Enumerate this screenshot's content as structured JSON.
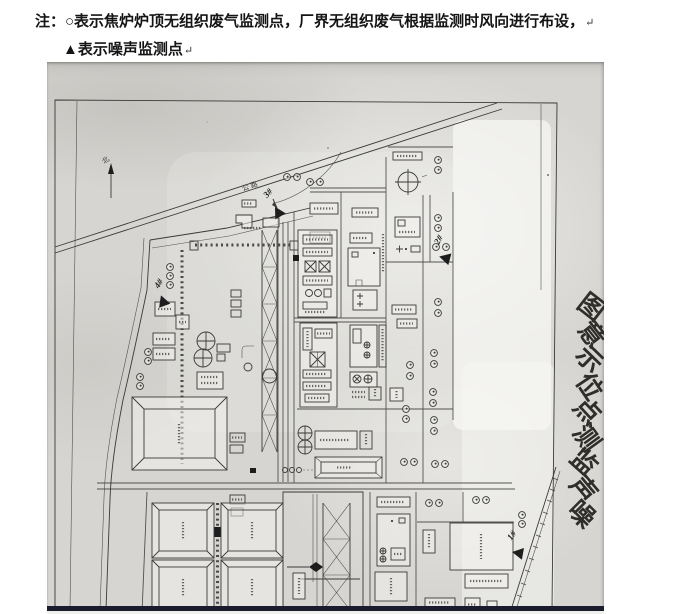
{
  "note": {
    "line1": "注：○表示焦炉炉顶无组织废气监测点，厂界无组织废气根据监测时风向进行布设，",
    "line2": "▲表示噪声监测点",
    "return_mark": "↵"
  },
  "scan": {
    "title": "噪声监测点位示意图",
    "title_layout": {
      "x0": 539,
      "y0": 252,
      "dx": -1.3,
      "dy": 25.8,
      "rots": [
        38,
        52,
        44,
        56,
        47,
        54,
        42,
        50,
        45
      ]
    },
    "north_label": "北",
    "north_pos": {
      "x": 60,
      "y": 100,
      "rot": -35
    },
    "road_label": "公路",
    "road_label_pos": {
      "x": 196,
      "y": 129,
      "rot": -19
    },
    "noise_points": [
      {
        "label": "1#",
        "x": 471,
        "y": 491,
        "lx": 467,
        "ly": 475,
        "rot": -55,
        "trot": -80,
        "leader": false
      },
      {
        "label": "2#",
        "x": 398,
        "y": 196,
        "lx": 394,
        "ly": 179,
        "rot": -62,
        "trot": -75,
        "leader": false
      },
      {
        "label": "3#",
        "x": 231,
        "y": 150,
        "lx": 223,
        "ly": 133,
        "rot": -48,
        "trot": -30,
        "leader": true
      },
      {
        "label": "4#",
        "x": 116,
        "y": 239,
        "lx": 114,
        "ly": 223,
        "rot": -58,
        "trot": -20,
        "leader": false
      }
    ],
    "gas_points": [
      [
        240,
        115
      ],
      [
        250,
        115
      ],
      [
        263,
        120
      ],
      [
        273,
        120
      ],
      [
        391,
        98
      ],
      [
        391,
        108
      ],
      [
        391,
        156
      ],
      [
        391,
        166
      ],
      [
        389,
        185
      ],
      [
        399,
        185
      ],
      [
        391,
        240
      ],
      [
        391,
        251
      ],
      [
        387,
        291
      ],
      [
        387,
        302
      ],
      [
        363,
        303
      ],
      [
        363,
        314
      ],
      [
        386,
        330
      ],
      [
        386,
        341
      ],
      [
        359,
        347
      ],
      [
        359,
        357
      ],
      [
        387,
        358
      ],
      [
        387,
        369
      ],
      [
        357,
        400
      ],
      [
        367,
        400
      ],
      [
        388,
        402
      ],
      [
        398,
        402
      ],
      [
        382,
        441
      ],
      [
        392,
        441
      ],
      [
        429,
        438
      ],
      [
        439,
        438
      ],
      [
        475,
        453
      ],
      [
        475,
        462
      ],
      [
        123,
        205
      ],
      [
        123,
        214
      ],
      [
        123,
        223
      ],
      [
        101,
        290
      ],
      [
        101,
        299
      ],
      [
        93,
        315
      ],
      [
        93,
        324
      ]
    ],
    "colors": {
      "paper": "#d6d5d1",
      "ink": "#3b3a37",
      "edge_band": "#1b1b2e",
      "marker": "#1d1d1d"
    }
  }
}
